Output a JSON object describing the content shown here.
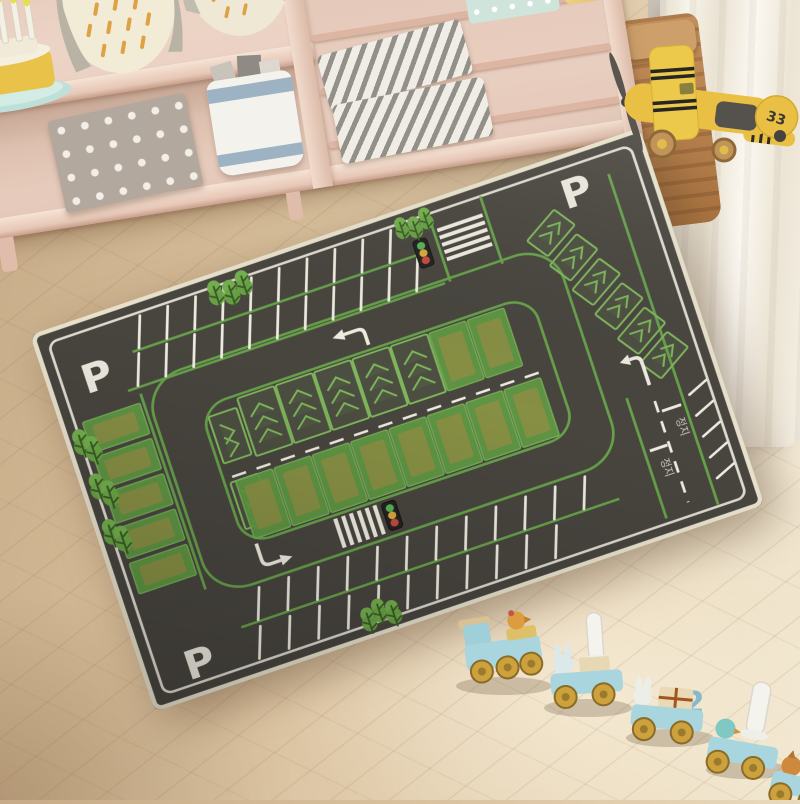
{
  "rug": {
    "parking_letter": "P",
    "stop_text": "정지"
  },
  "plane": {
    "tail_number": "33"
  },
  "train": {
    "car_number": "2"
  },
  "palette": {
    "rug_base": "#48453f",
    "rug_green": "#66a14a",
    "rug_marking_white": "#efece1",
    "rug_binding": "#e8e2cd",
    "bay_green": "#5f9b43",
    "bay_olive": "#8e8e44",
    "traffic_green": "#58b257",
    "traffic_yellow": "#d9a83e",
    "traffic_red": "#c44a3e",
    "floor_wood": "#d9c09e",
    "shelf_wood": "#e9cfc0",
    "plane_yellow": "#e9c044",
    "train_blue": "#a9d6de",
    "wheel_yellow": "#cda23d",
    "curtain_white": "#f7f3e9",
    "basket_brown": "#b07a4a"
  }
}
